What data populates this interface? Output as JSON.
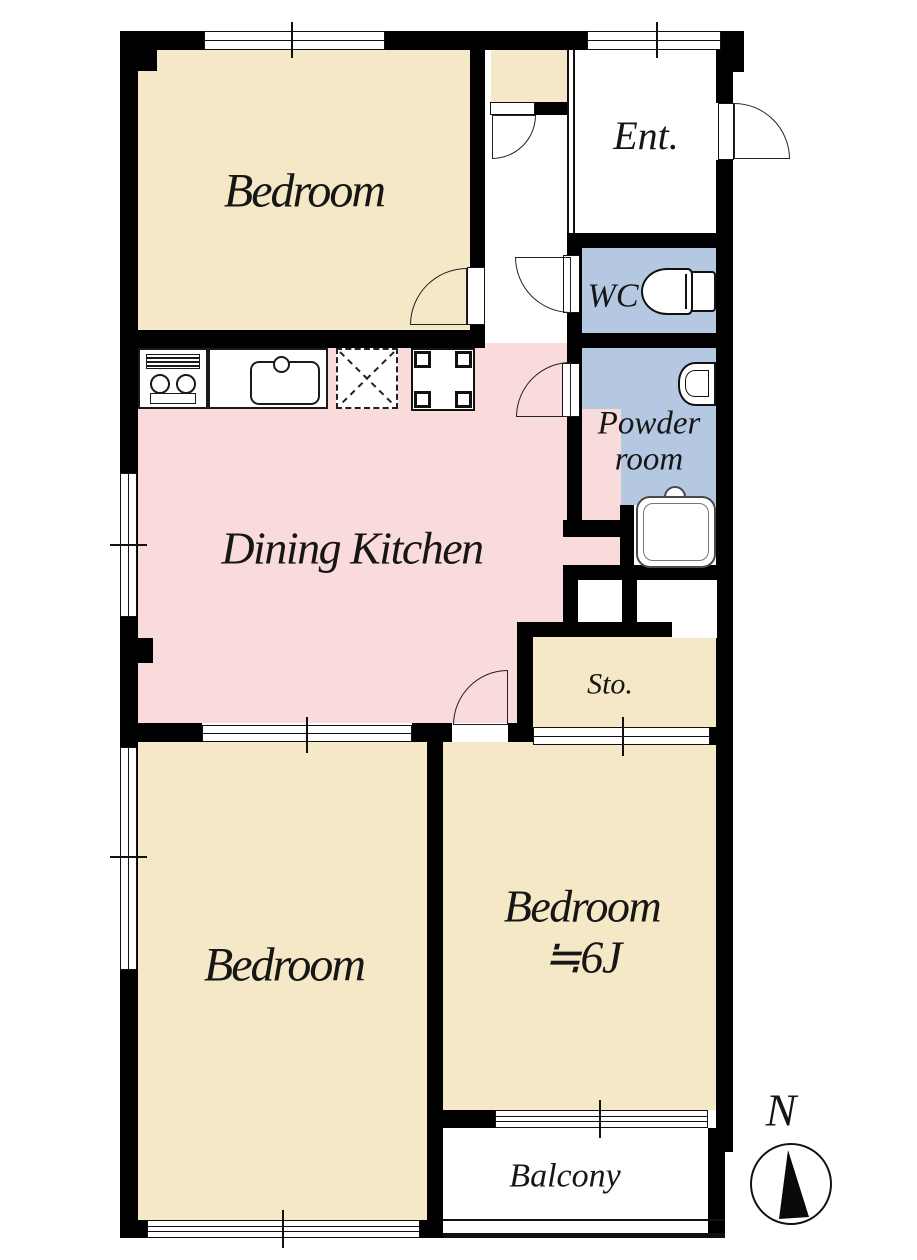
{
  "plan": {
    "rooms": {
      "bedroom_nw": {
        "label": "Bedroom"
      },
      "entrance": {
        "label": "Ent."
      },
      "wc": {
        "label": "WC"
      },
      "powder_room": {
        "label_line1": "Powder",
        "label_line2": "room"
      },
      "dining_kitchen": {
        "label": "Dining Kitchen"
      },
      "storage": {
        "label": "Sto."
      },
      "bedroom_sw": {
        "label": "Bedroom"
      },
      "bedroom_se": {
        "label_line1": "Bedroom",
        "label_line2": "≒6J"
      },
      "balcony": {
        "label": "Balcony"
      }
    },
    "compass": {
      "north_label": "N"
    },
    "fixtures": {
      "stove": "stove-icon",
      "sink": "sink-icon",
      "refrigerator_space": "refrigerator-icon",
      "washing_machine_space": "washing-machine-icon",
      "toilet": "toilet-icon",
      "washbasin": "washbasin-icon",
      "bathtub": "bathtub-icon",
      "compass": "compass-icon"
    },
    "colors": {
      "beige": "#f5e8c6",
      "pink": "#fadbdc",
      "blue": "#b5c8e2",
      "wall": "#000000"
    }
  }
}
